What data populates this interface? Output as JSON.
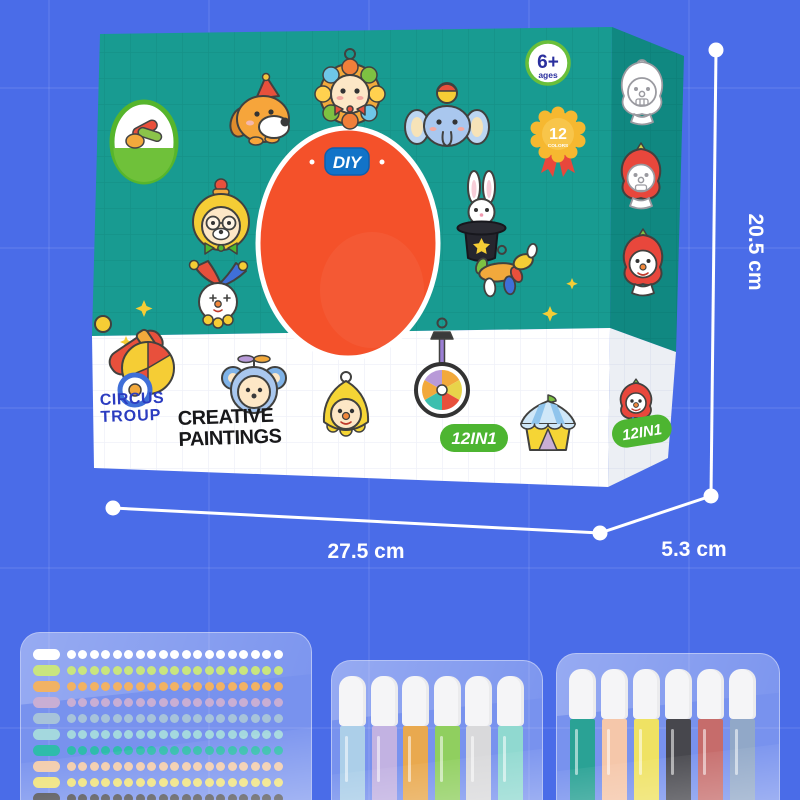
{
  "product": {
    "diy_label": "DIY",
    "brand_lines": [
      "CIRCUS",
      "TROUP"
    ],
    "title_lines": [
      "CREATIVE",
      "PAINTINGS"
    ],
    "age_badge": {
      "value": "6+",
      "unit": "ages"
    },
    "colors_badge": {
      "value": "12",
      "unit": "COLORS"
    },
    "set_badge": "12IN1",
    "set_badge_2": "12IN1",
    "stickers": [
      "brand-logo",
      "dog-with-party-hat",
      "lion",
      "elephant-with-ball",
      "bear-acrobat",
      "rabbit-in-magic-hat",
      "jester-clown",
      "balloon-dog",
      "circus-cannon",
      "mouse-pilot",
      "yellow-clown",
      "unicycle",
      "circus-tent",
      "clown-outline",
      "red-clown-half-painted",
      "red-clown-painted",
      "red-clown-small"
    ]
  },
  "dimensions": {
    "width_label": "27.5 cm",
    "height_label": "20.5 cm",
    "depth_label": "5.3 cm"
  },
  "contents": {
    "bead_strips": {
      "count": 10,
      "colors": [
        "#ffffff",
        "#c9e57f",
        "#f1b264",
        "#c9aed4",
        "#a7c3da",
        "#a4d8de",
        "#2fbcab",
        "#f2cbaa",
        "#efe27a",
        "#4b4b4f"
      ]
    },
    "pens_left": {
      "count": 6,
      "colors": [
        "#accfe9",
        "#c2b2e2",
        "#e9a94f",
        "#90cf5f",
        "#d9d9db",
        "#90d9d0"
      ]
    },
    "pens_right": {
      "count": 6,
      "colors": [
        "#2aa295",
        "#f5c7aa",
        "#efe263",
        "#47474d",
        "#c66c6b",
        "#91a8c8"
      ]
    }
  },
  "theme": {
    "bg": "#4a6ce8",
    "box-teal": "#189b91",
    "band": "#ffffff",
    "oval-orange": "#f4512a",
    "diy-blue": "#1273c8",
    "badge-green": "#4db531",
    "brand-blue": "#2b3cc0",
    "title-black": "#18181a",
    "dim-white": "#ffffff",
    "age-blue": "#2a2f9e",
    "rosette-yellow": "#f6b830",
    "ribbon-red": "#e8473c",
    "logo-green": "#56b52c"
  }
}
